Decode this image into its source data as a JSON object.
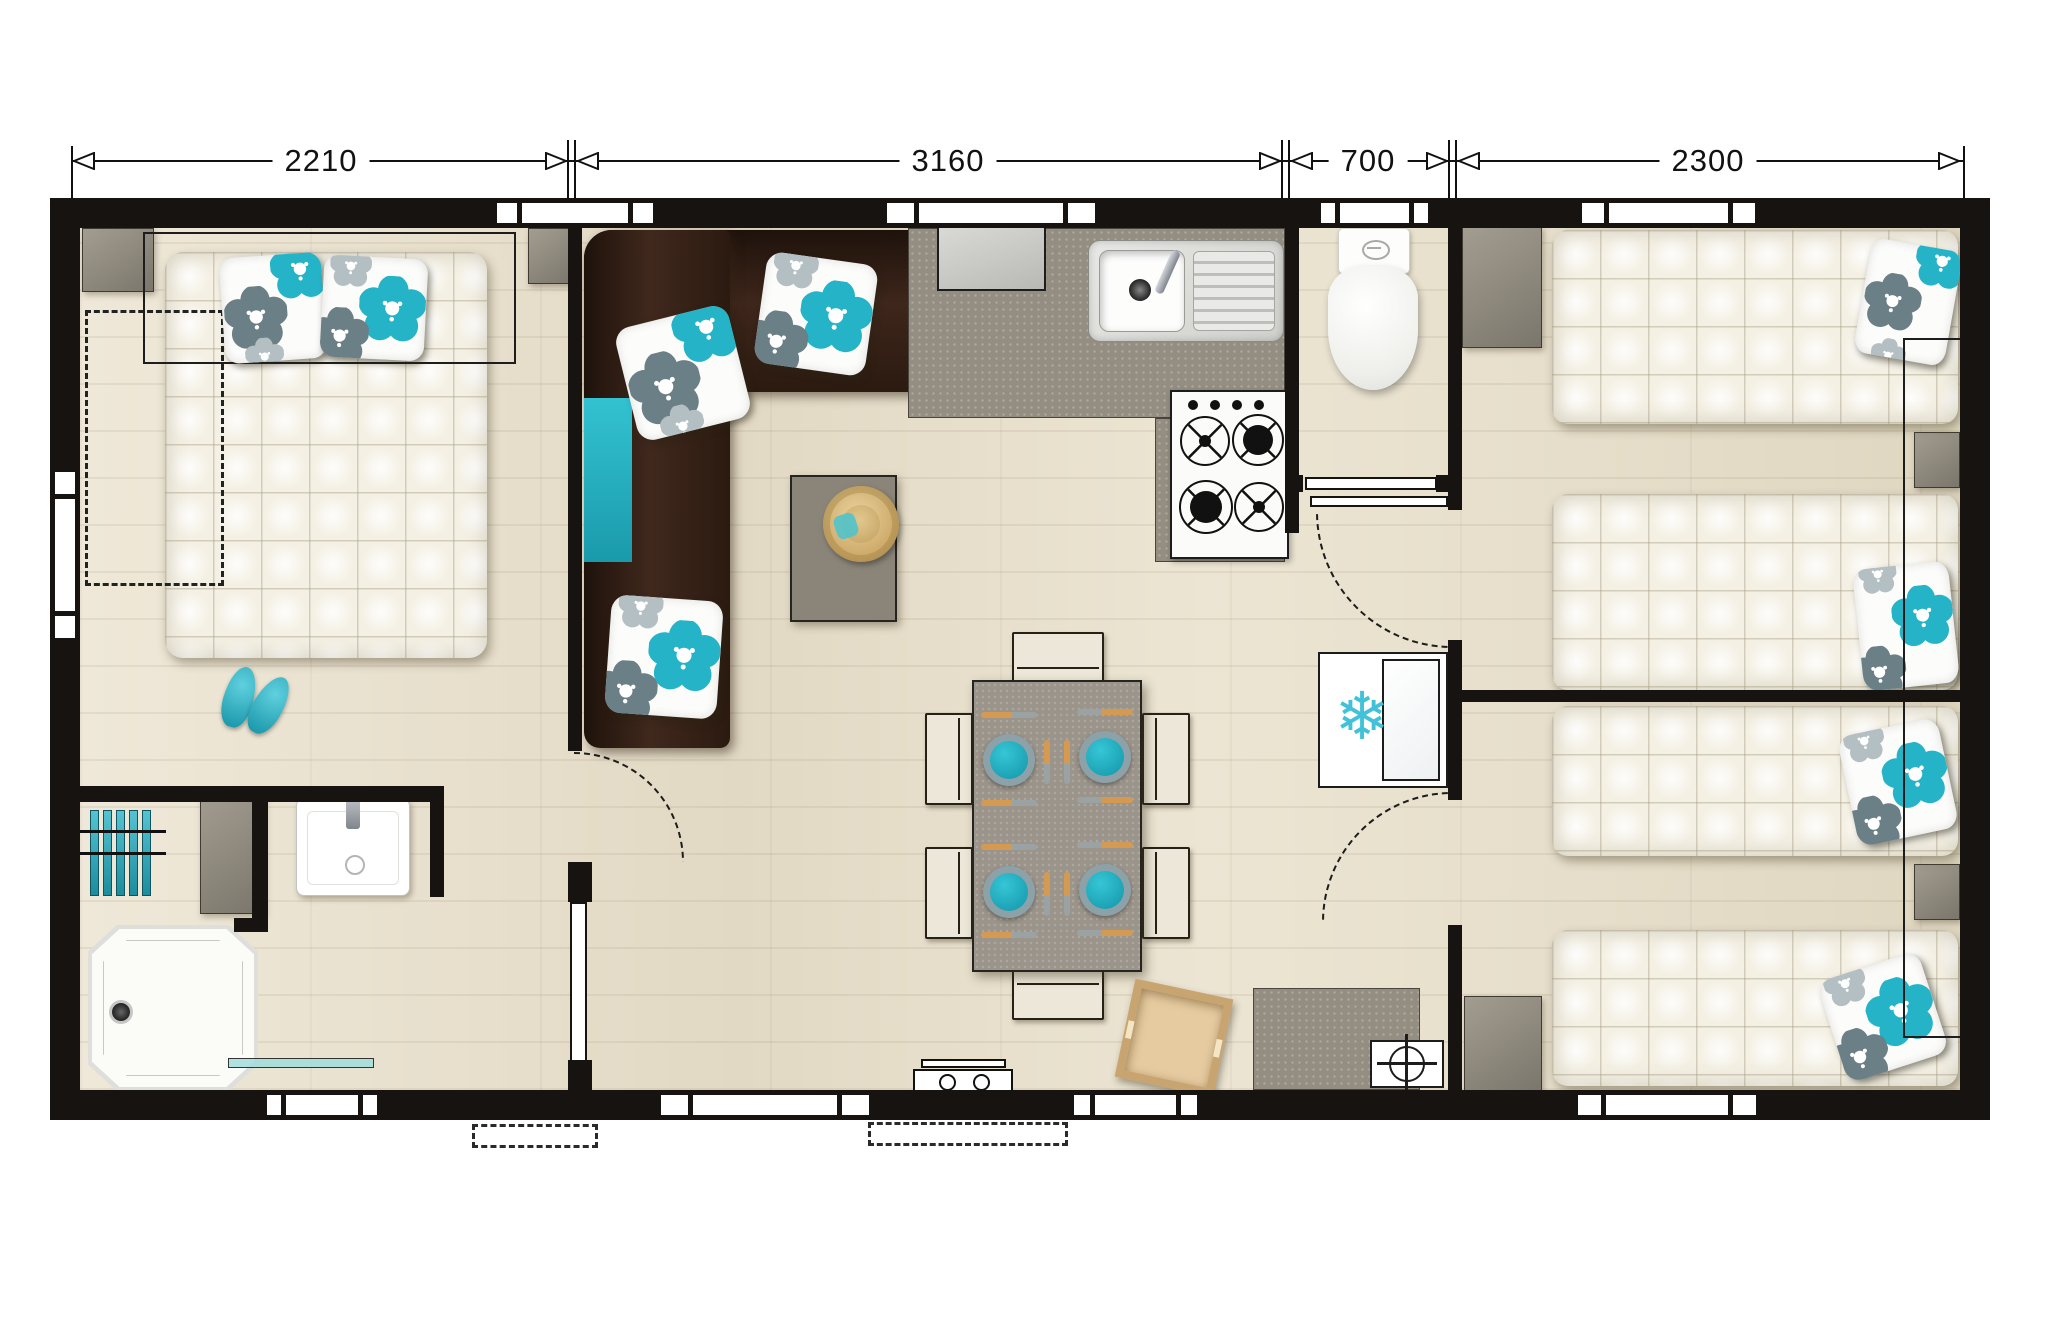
{
  "figure_type": "mobile-home floor plan, top-down view",
  "dimension_line": {
    "segments": [
      {
        "label": "2210"
      },
      {
        "label": "3160"
      },
      {
        "label": "700"
      },
      {
        "label": "2300"
      }
    ]
  },
  "fridge_glyph": "❄",
  "palette": {
    "wall_black": "#171310",
    "accent_teal": "#2cb7c9",
    "pillow_gray": "#6b7f86",
    "sofa_brown": "#38221a",
    "counter_gray": "#948e82",
    "furniture_cream": "#ece7d8",
    "floor_wood": "#e8e0cd",
    "plate_teal": "#18a6ba",
    "crate_wood": "#e6cba0"
  },
  "icons": {
    "fridge": "snowflake-icon",
    "boiler": "circle-crosshair-icon",
    "hob": "gas-burner-icon",
    "sink": "kitchen-sink-icon",
    "basin": "wash-basin-icon",
    "toilet": "toilet-icon",
    "shower": "shower-tray-icon",
    "radiator": "towel-radiator-icon",
    "hat": "straw-hat-icon",
    "slippers": "flip-flops-icon",
    "crate": "wooden-crate-icon",
    "entrance_step": "folding-step-icon",
    "doors": "door-swing-arc-icon"
  }
}
